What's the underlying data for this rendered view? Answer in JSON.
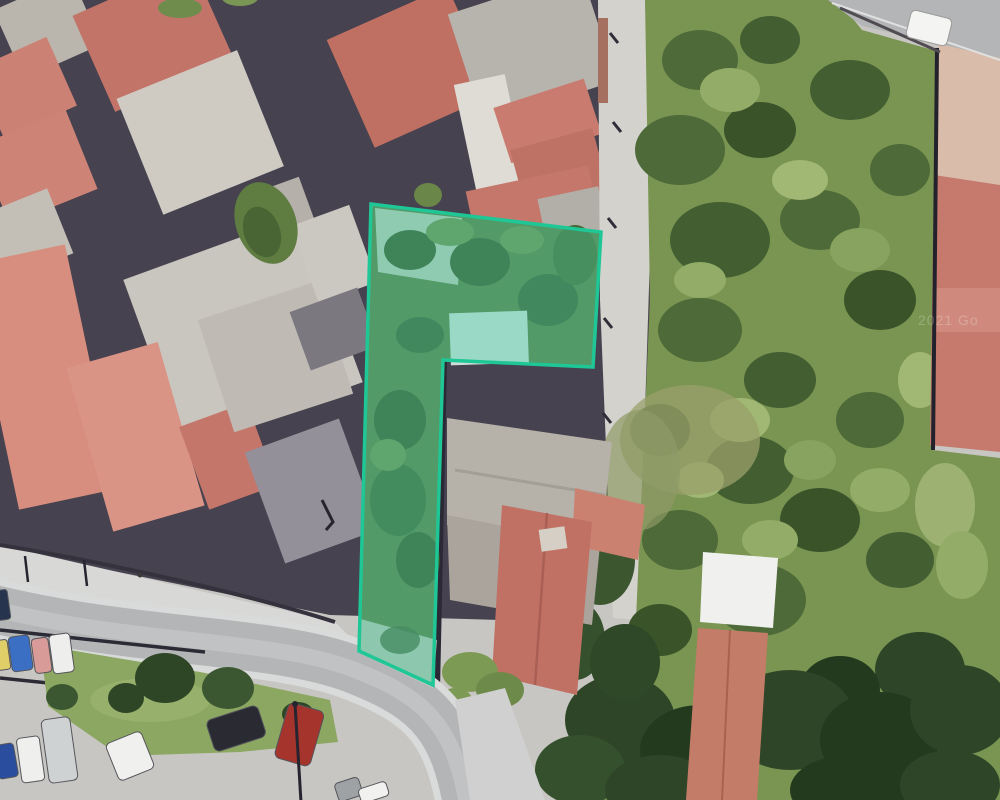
{
  "scene": {
    "type": "satellite-aerial-view",
    "features": [
      "terracotta-roof residential block",
      "overgrown green vacant lot",
      "highlighted property parcel",
      "curved street",
      "landscaped traffic island with trees",
      "roadside parked cars",
      "parking area",
      "white-roofed shed",
      "footpath with utility poles"
    ]
  },
  "parcel": {
    "points": "371,204 601,232 593,367 443,360 433,685 359,651",
    "stroke_color": "#1ec795",
    "fill_color": "#46d6a8",
    "fill_opacity": "0.38",
    "stroke_width": "3.5"
  },
  "watermark": {
    "text": "2021 Go"
  },
  "palette": {
    "pavement": "#c7c6c2",
    "road": "#b3b5b7",
    "sidewalk": "#d8d8d7",
    "roof_red": "#c0706a",
    "roof_salmon": "#d88e7e",
    "roof_gray": "#c9c6bf",
    "roof_white": "#f0f1ee",
    "vegetation_lot": "#7a9452",
    "grass_island": "#8ca761",
    "tree_dark": "#2f4527",
    "shadow": "#46424f"
  },
  "vehicles": [
    {
      "name": "white-car-top-right",
      "color": "#f4f4f2"
    },
    {
      "name": "blue-car-street-left",
      "color": "#3a6fc4"
    },
    {
      "name": "pink-car-street-left",
      "color": "#d89b97"
    },
    {
      "name": "white-van-street-left",
      "color": "#eeeeec"
    },
    {
      "name": "yellow-car-street-left",
      "color": "#e0cf68"
    },
    {
      "name": "dark-blue-car-left-edge",
      "color": "#26354d"
    },
    {
      "name": "blue-car-parking",
      "color": "#2b4d9e"
    },
    {
      "name": "white-car-parking",
      "color": "#efefed"
    },
    {
      "name": "silver-van-parking",
      "color": "#cfd2d2"
    },
    {
      "name": "white-car-parking-2",
      "color": "#f0f0ee"
    },
    {
      "name": "dark-suv-parking",
      "color": "#2a2a33"
    },
    {
      "name": "red-car-parking",
      "color": "#a5342c"
    },
    {
      "name": "gray-car-bottom-edge",
      "color": "#9ea2a5"
    },
    {
      "name": "white-car-bottom-edge",
      "color": "#f1f1ef"
    }
  ]
}
